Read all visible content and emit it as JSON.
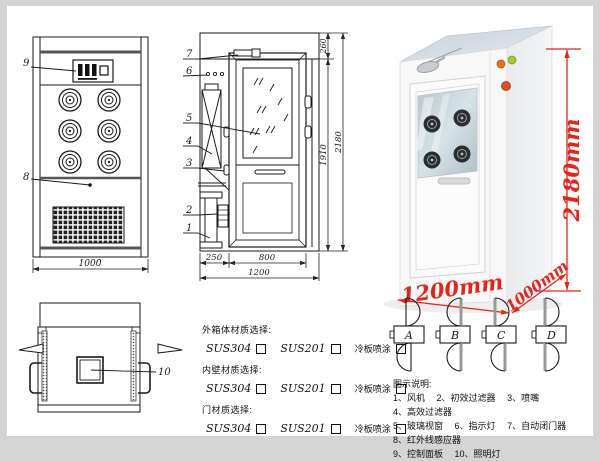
{
  "colors": {
    "dim_red": "#e8231a",
    "line": "#1a1a1a"
  },
  "front_view": {
    "label_9": "9",
    "label_8": "8",
    "width_dim": "1000"
  },
  "section_view": {
    "labels": [
      "7",
      "6",
      "5",
      "4",
      "3",
      "2",
      "1"
    ],
    "dim_left": "250",
    "dim_door": "800",
    "dim_total_w": "1200",
    "dim_top": "260",
    "dim_inner_h": "1910",
    "dim_total_h": "2180"
  },
  "top_view": {
    "label_10": "10"
  },
  "photo": {
    "height": "2180mm",
    "width": "1200mm",
    "depth": "1000mm"
  },
  "door_types": {
    "letters": [
      "A",
      "B",
      "C",
      "D"
    ]
  },
  "materials": {
    "groups": [
      {
        "title": "外箱体材质选择:",
        "options": [
          "SUS304",
          "SUS201",
          "冷板喷涂"
        ]
      },
      {
        "title": "内壁材质选择:",
        "options": [
          "SUS304",
          "SUS201",
          "冷板喷涂"
        ]
      },
      {
        "title": "门材质选择:",
        "options": [
          "SUS304",
          "SUS201",
          "冷板喷涂"
        ]
      }
    ]
  },
  "legend": {
    "title": "图示说明:",
    "items": [
      "1、风机",
      "2、初效过滤器",
      "3、喷嘴",
      "4、高效过滤器",
      "5、玻璃视窗",
      "6、指示灯",
      "7、自动闭门器",
      "8、红外线感应器",
      "9、控制面板",
      "10、照明灯"
    ]
  }
}
